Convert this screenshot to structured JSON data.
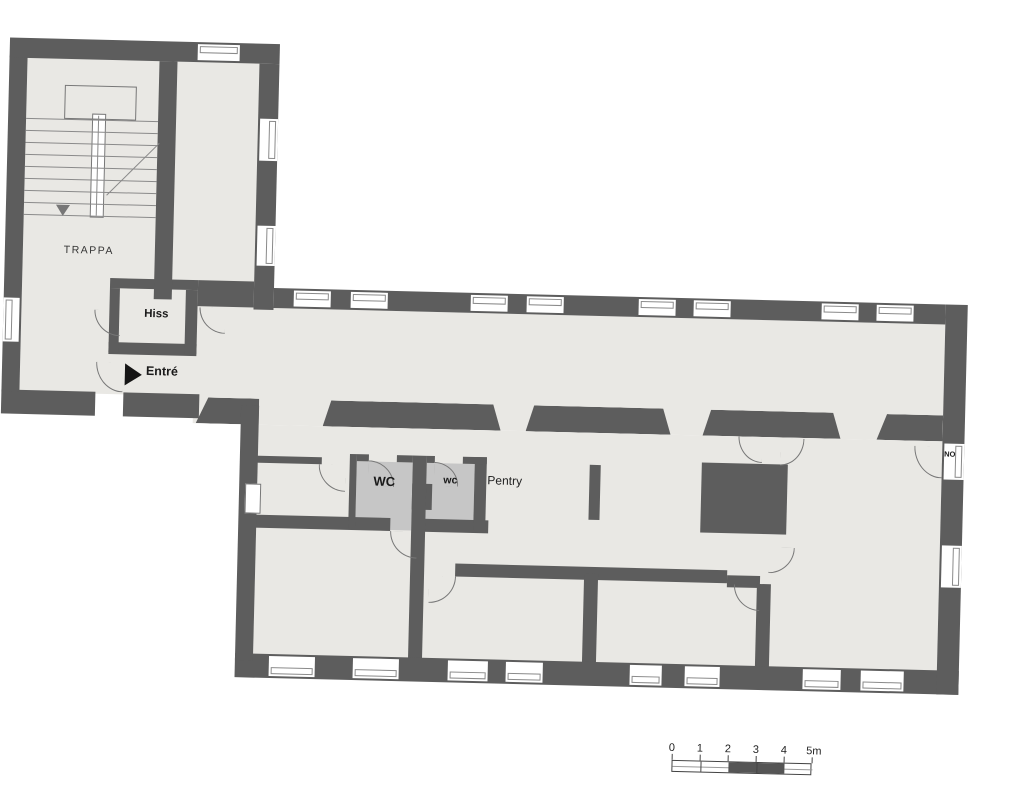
{
  "plan": {
    "labels": {
      "stairwell": "TRAPPA",
      "elevator": "Hiss",
      "entrance": "Entré",
      "wc_large": "WC",
      "wc_small": "wc",
      "pantry": "Pentry",
      "partial_door_label": "NO"
    },
    "scale_bar": {
      "tick_labels": [
        "0",
        "1",
        "2",
        "3",
        "4",
        "5m"
      ]
    }
  },
  "colors": {
    "wall": "#5d5d5d",
    "floor": "#e9e8e4",
    "room_fill": "#c6c6c6",
    "line": "#777777",
    "text": "#1a1a1a"
  }
}
